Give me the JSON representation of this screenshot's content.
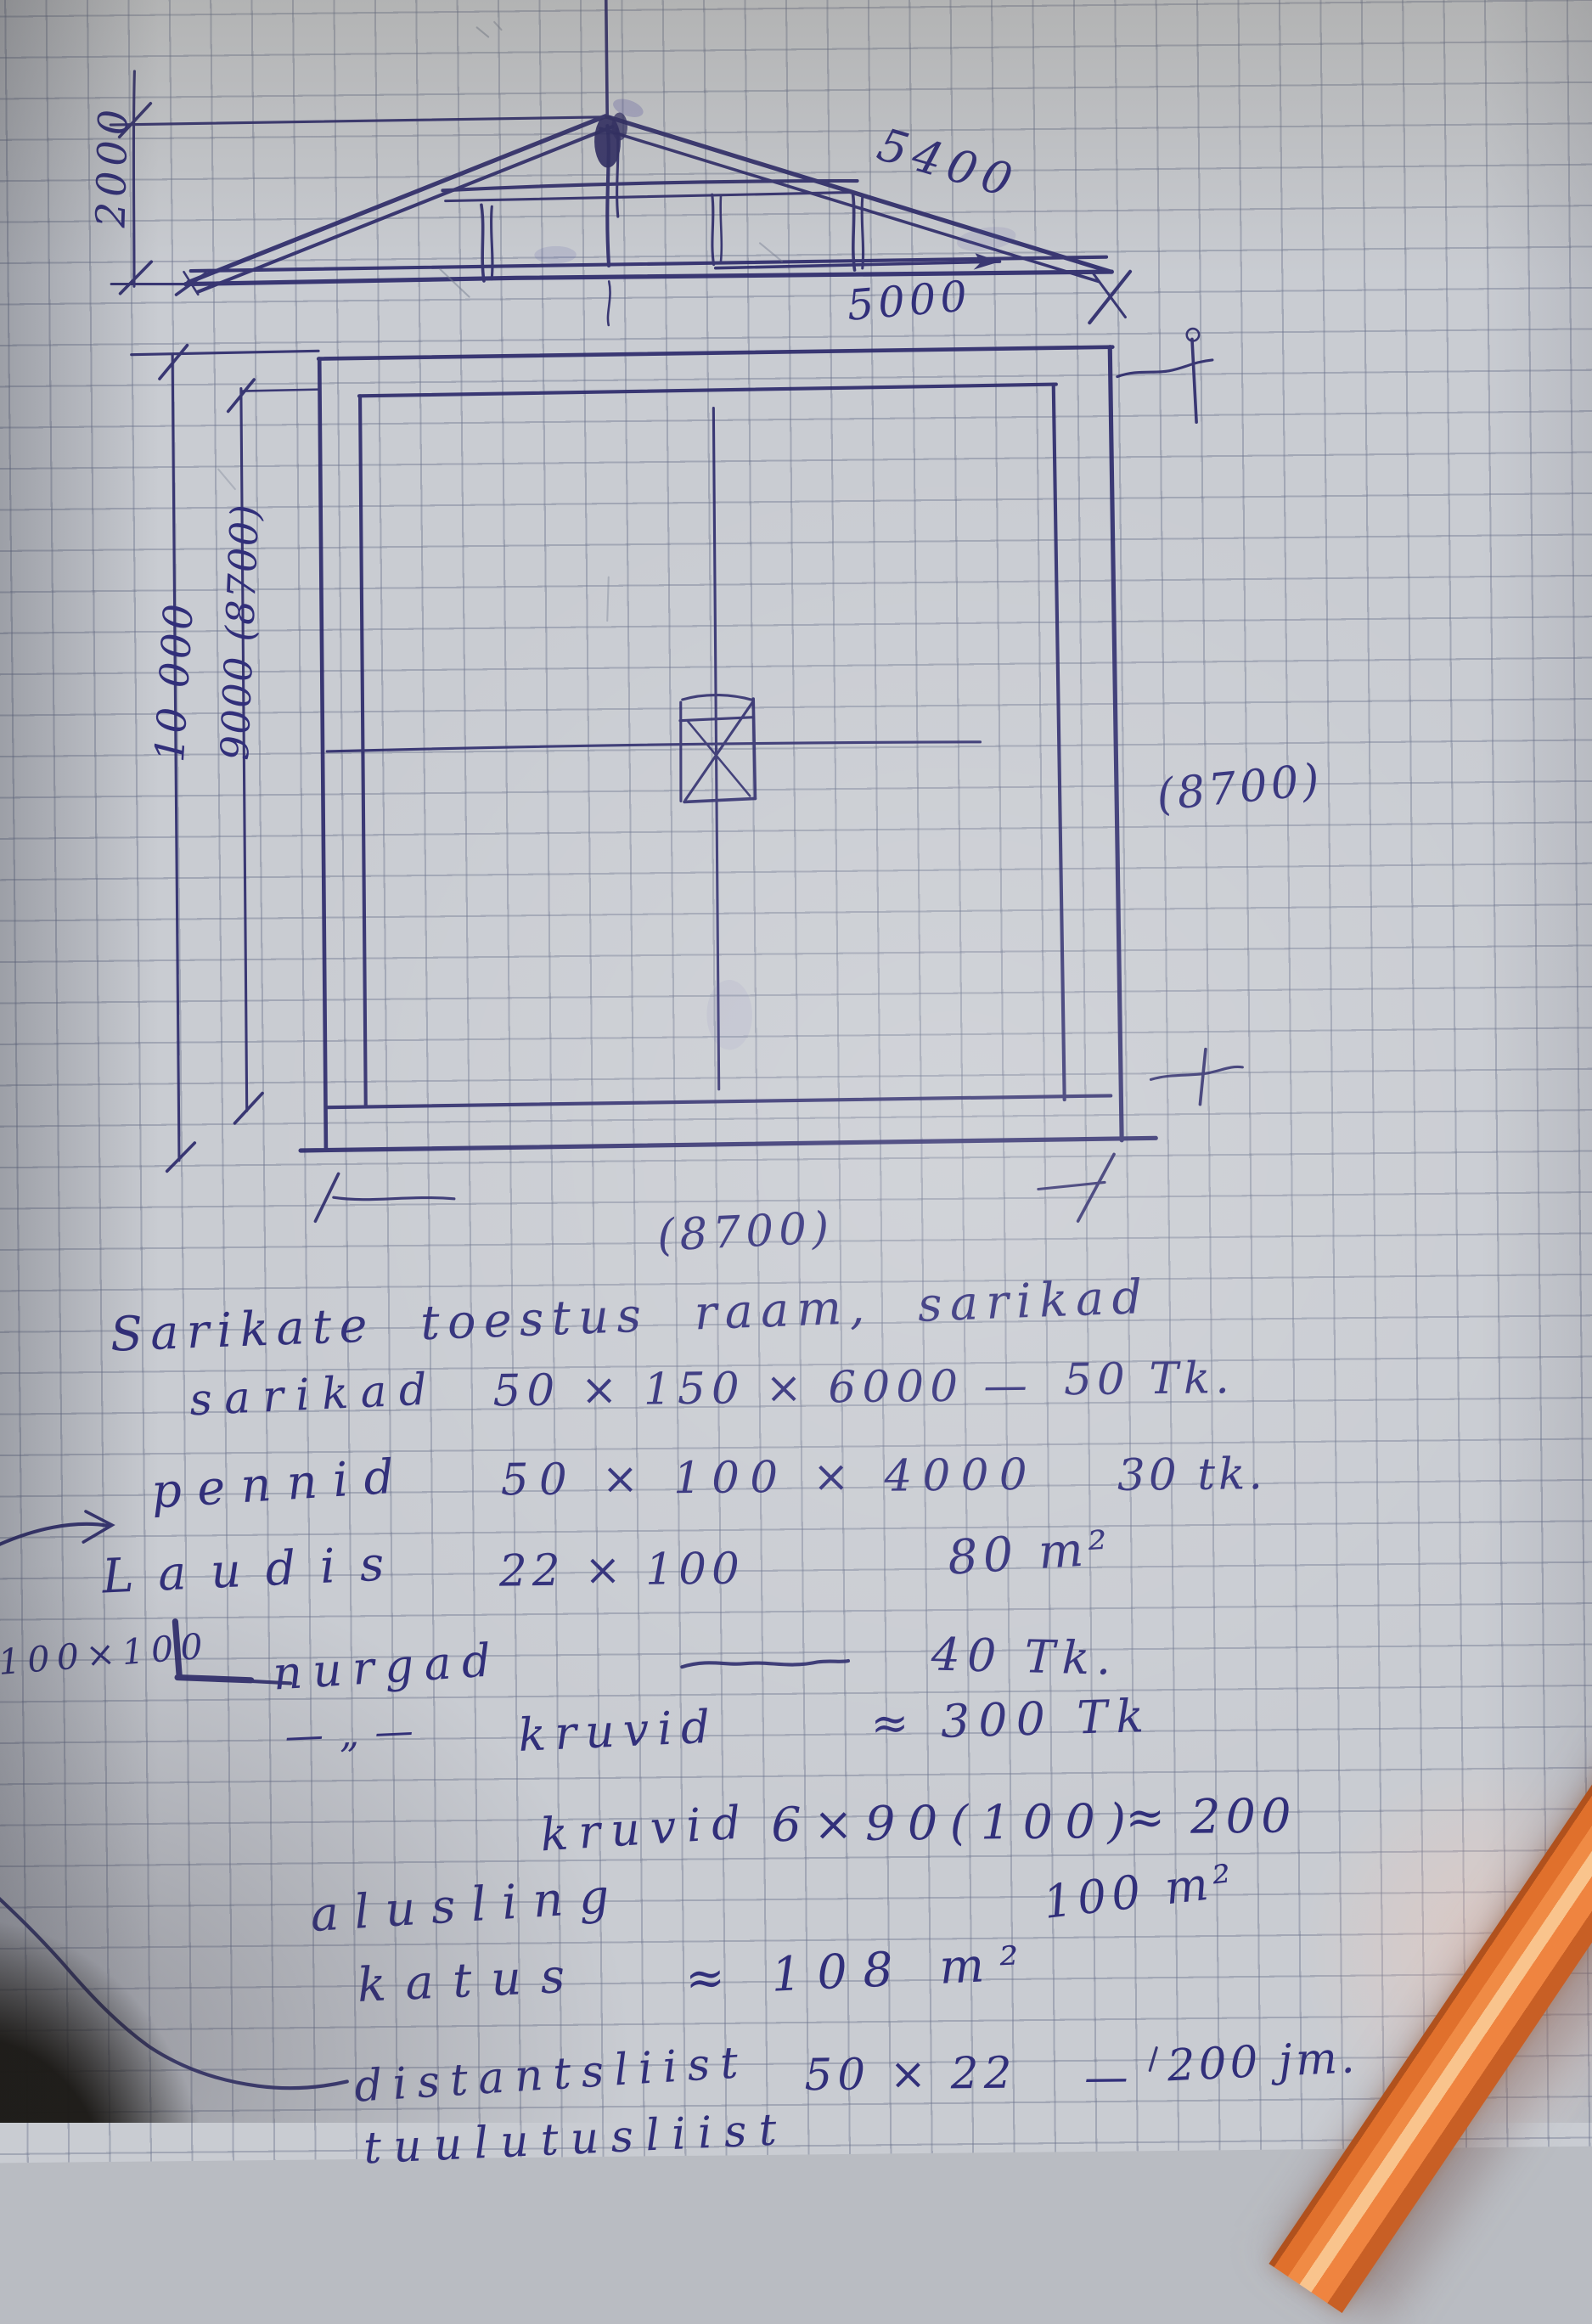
{
  "dims": {
    "rise": "2000",
    "rafter": "5400",
    "half_span": "5000",
    "height_outer": "10 000",
    "height_inner": "9000 (8700)",
    "width_right": "(8700)",
    "width_bottom": "(8700)"
  },
  "notes": {
    "title": "Sarikate toestus raam, sarikad",
    "r1": {
      "item": "sarikad",
      "size": "50 × 150 × 6000",
      "dash": "—",
      "qty": "50 Tk."
    },
    "r2": {
      "item": "pennid",
      "size": "50 × 100 × 4000",
      "qty": "30 tk."
    },
    "r3": {
      "item": "Laudis",
      "size": "22 × 100",
      "qty": "80 m²"
    },
    "r4": {
      "prefix": "100×100",
      "item": "nurgad",
      "qty": "40 Tk."
    },
    "r5": {
      "ditto": "— „ —",
      "item": "kruvid",
      "qty": "≈ 300 Tk"
    },
    "r6": {
      "item": "kruvid",
      "size": "6×90(100)",
      "qty": "≈ 200"
    },
    "r7": {
      "item": "alusling",
      "qty": "100 m²"
    },
    "r8": {
      "item": "katus",
      "qty": "≈ 108 m²"
    },
    "r9": {
      "item": "distantsliist",
      "size": "50 × 22",
      "dash": "—",
      "qty": "200 jm."
    },
    "r10": {
      "item": "tuulutusliist"
    }
  },
  "ink_color": "#2d2b6b",
  "pencil_color": "#e8803a"
}
